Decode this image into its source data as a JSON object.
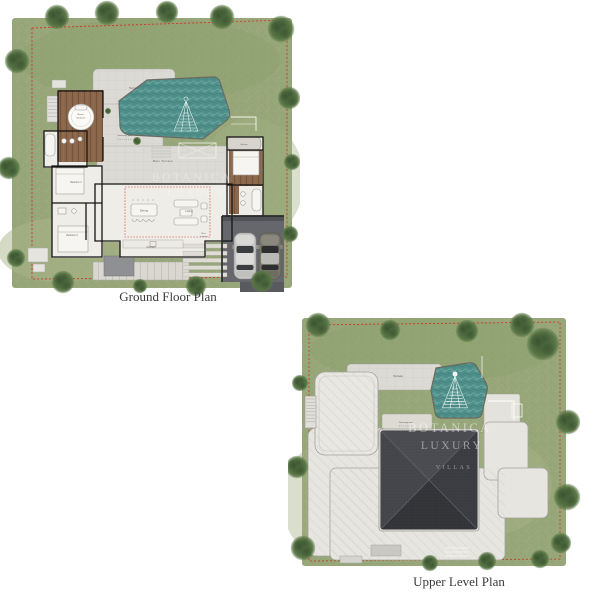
{
  "page": {
    "background": "#ffffff"
  },
  "brand_watermark": {
    "line1": "BOTANICA",
    "line2": "LUXURY",
    "line3": "VILLAS"
  },
  "ground_plan": {
    "caption": "Ground Floor Plan",
    "labels": {
      "terrace": "Terrace",
      "swimming_pool_line1": "Swimming pool",
      "swimming_pool_line2": "Terrace",
      "main_terrace": "Main Terrace",
      "dining": "Dining",
      "living": "Living",
      "kitchen": "Kitchen",
      "master_line1": "Master",
      "master_line2": "Bedroom",
      "bedroom1": "Bedroom 1",
      "bedroom2": "Bedroom 2",
      "bedroom3": "Bedroom 3",
      "balcony": "Balcony",
      "entrance_line1": "Main",
      "entrance_line2": "entrance"
    }
  },
  "upper_plan": {
    "caption": "Upper Level Plan",
    "labels": {
      "terrace": "Terrace",
      "swimming_pool_line1": "Swimming pool",
      "swimming_pool_line2": "Terrace"
    }
  },
  "colors": {
    "page_bg": "#ffffff",
    "caption": "#3b3b3b",
    "grass": "#98a77a",
    "grass_dark": "#8ba06c",
    "grass_light": "#a9b689",
    "tree": "#4c683d",
    "pool_water": "#4f8f8a",
    "pool_ripple": "#77b0a9",
    "wood_deck": "#8a664a",
    "floor": "#efede8",
    "paving": "#dcdad4",
    "roof_light": "#e6e5e0",
    "roof_dark": "#404146",
    "carport": "#66676c",
    "wall": "#141414",
    "boundary_dashed": "#c4412f",
    "inner_dashed": "#cc3b2e",
    "watermark": "#ffffff"
  }
}
